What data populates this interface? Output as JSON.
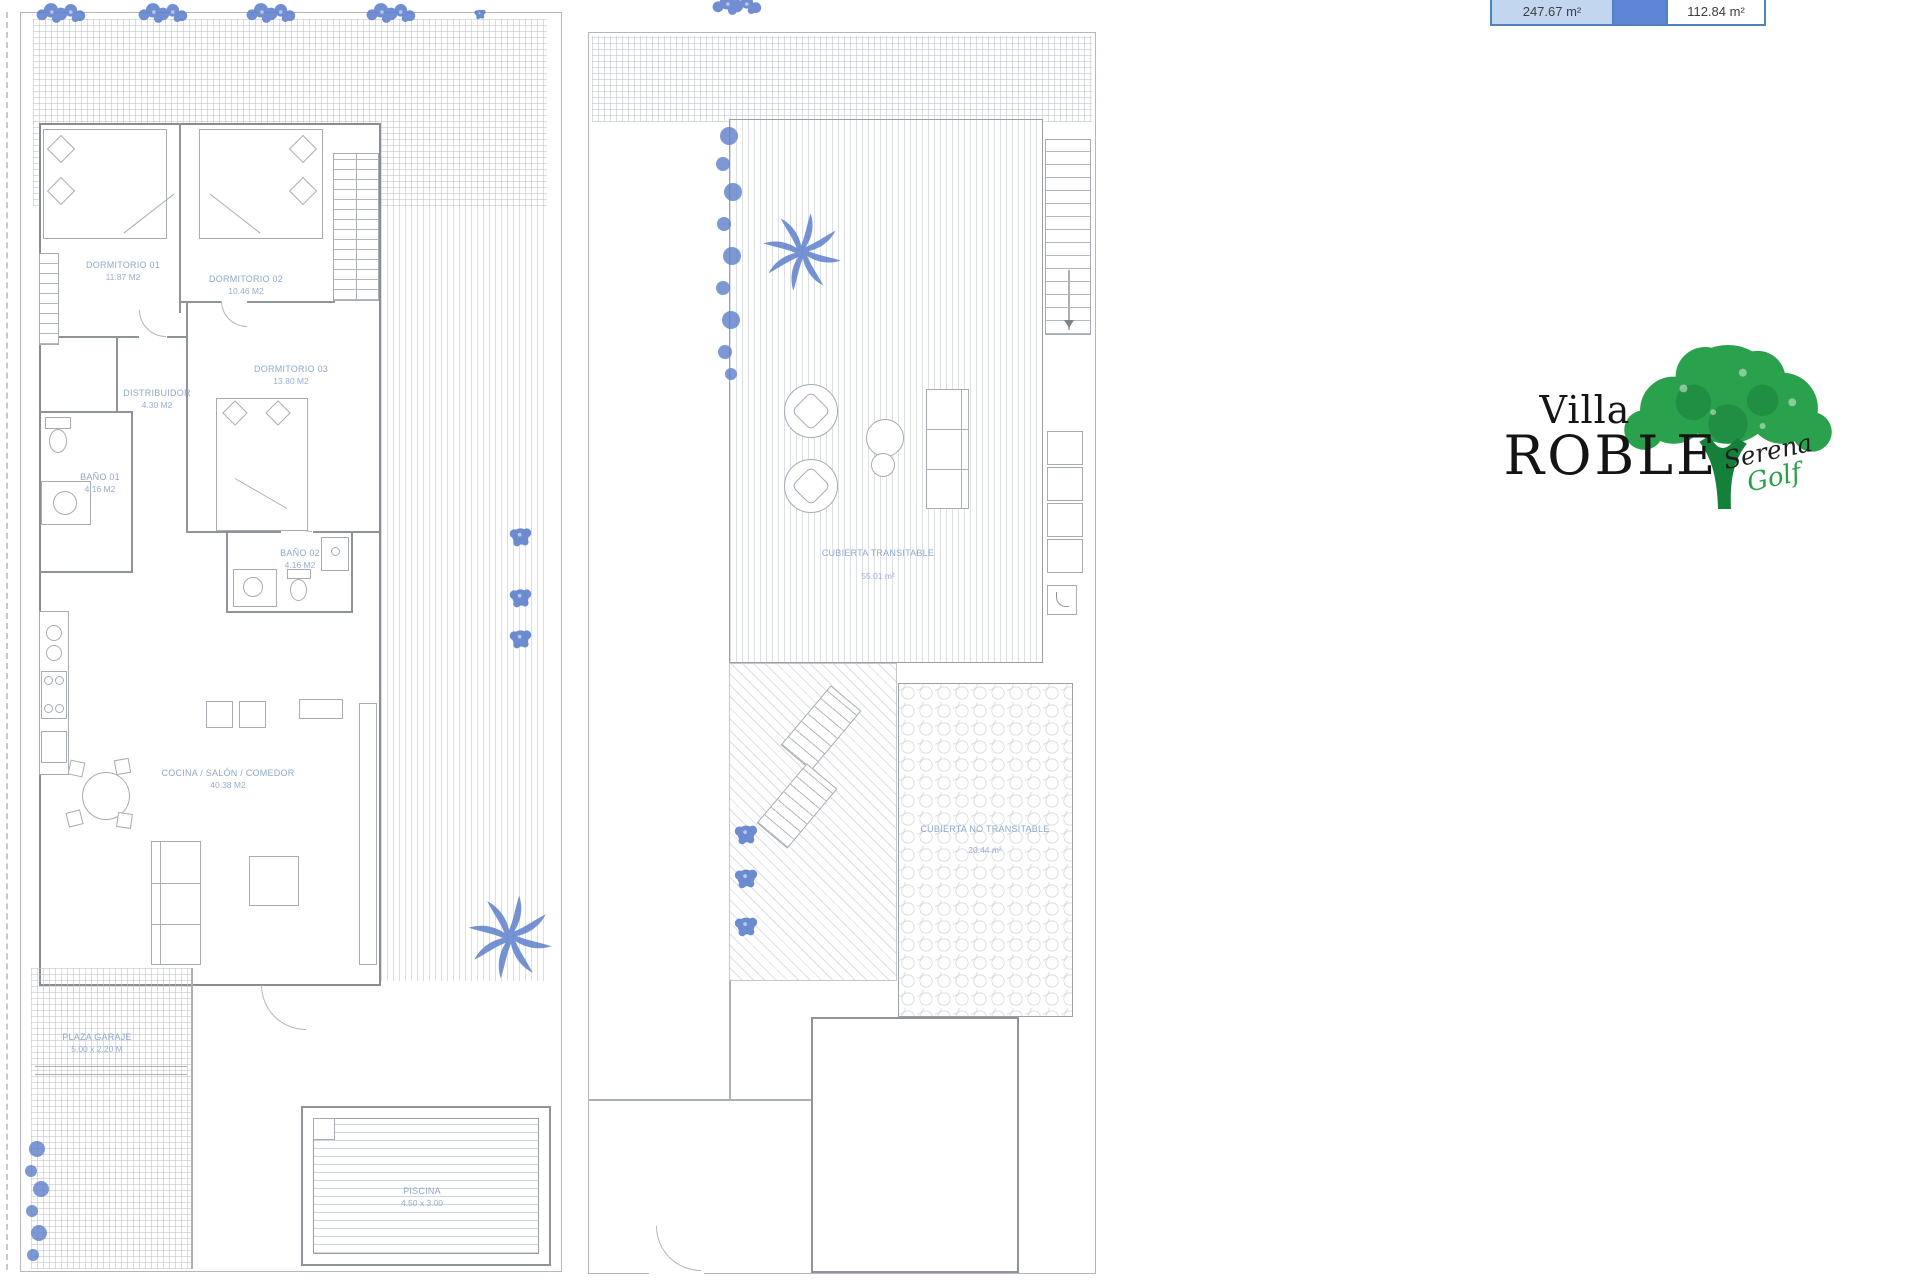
{
  "summary_table": {
    "left_value": "247.67 m²",
    "right_value": "112.84 m²"
  },
  "logo": {
    "title_line1": "Villa",
    "title_line2": "ROBLE",
    "script_line1": "Serena",
    "script_line2": "Golf"
  },
  "ground_floor": {
    "rooms": [
      {
        "name": "DORMITORIO 01",
        "area": "11.87 M2"
      },
      {
        "name": "DORMITORIO 02",
        "area": "10.46 M2"
      },
      {
        "name": "DORMITORIO 03",
        "area": "13.80 M2"
      },
      {
        "name": "DISTRIBUIDOR",
        "area": "4.30 M2"
      },
      {
        "name": "BAÑO 01",
        "area": "4.16 M2"
      },
      {
        "name": "BAÑO 02",
        "area": "4.16 M2"
      },
      {
        "name": "COCINA / SALÓN / COMEDOR",
        "area": "40.38 M2"
      },
      {
        "name": "PLAZA GARAJE",
        "area": "5.00 x 2.20 M"
      },
      {
        "name": "PISCINA",
        "area": "4.50 x 3.00"
      }
    ]
  },
  "roof_plan": {
    "areas": [
      {
        "name": "CUBIERTA TRANSITABLE",
        "area": "55.01 m²"
      },
      {
        "name": "CUBIERTA NO TRANSITABLE",
        "area": "20.44 m²"
      }
    ]
  },
  "icons": {
    "palm_tree": "palm-tree-icon",
    "shrub": "shrub-icon",
    "bush": "bush-icon",
    "vine": "vine-icon",
    "oak_tree": "oak-tree-icon"
  },
  "colors": {
    "plan_line": "#9aa0a6",
    "label_text": "#8ea8ca",
    "plant_blue": "#5d7fcb",
    "tree_green": "#2aa14d",
    "table_border": "#4f81bd",
    "table_cell_light": "#c3d6f0",
    "table_cell_mid": "#5f86d6"
  }
}
